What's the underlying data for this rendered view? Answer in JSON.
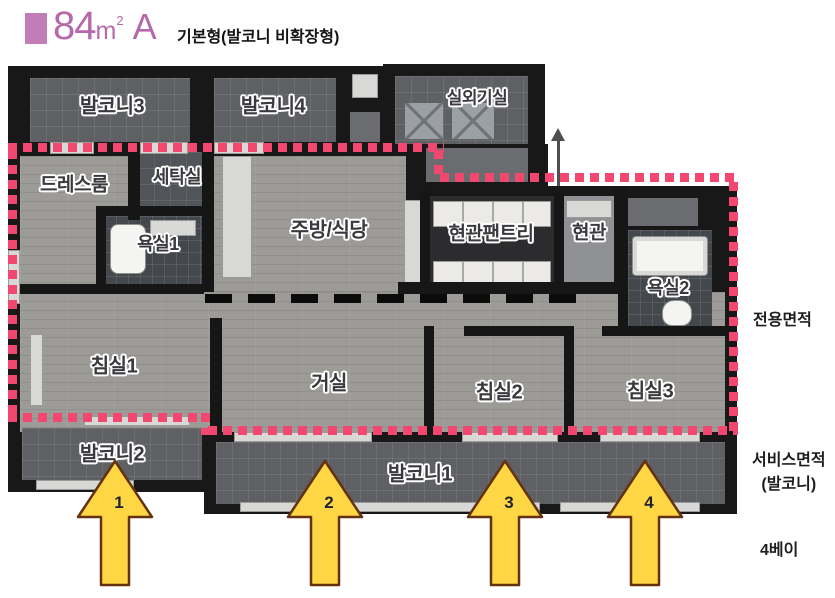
{
  "header": {
    "area_number": "84",
    "area_unit": "m",
    "area_sup": "2",
    "plan_type": "A",
    "subtitle": "기본형(발코니 비확장형)"
  },
  "rooms": {
    "balcony3": "발코니3",
    "balcony4": "발코니4",
    "outdoor_unit": "실외기실",
    "dressroom": "드레스룸",
    "laundry": "세탁실",
    "bath1": "욕실1",
    "kitchen": "주방/식당",
    "pantry": "현관팬트리",
    "entrance": "현관",
    "bath2": "욕실2",
    "bedroom1": "침실1",
    "living": "거실",
    "bedroom2": "침실2",
    "bedroom3": "침실3",
    "balcony2": "발코니2",
    "balcony1": "발코니1"
  },
  "annotations": {
    "exclusive_area": "전용면적",
    "service_area_line1": "서비스면적",
    "service_area_line2": "(발코니)",
    "bay": "4베이"
  },
  "arrows": [
    {
      "number": "1"
    },
    {
      "number": "2"
    },
    {
      "number": "3"
    },
    {
      "number": "4"
    }
  ],
  "colors": {
    "title_purple": "#b768ab",
    "boundary_pink": "#f2486f",
    "arrow_yellow": "#ffd643",
    "arrow_border": "#64320f",
    "dash_black": "#0b0b0b"
  }
}
